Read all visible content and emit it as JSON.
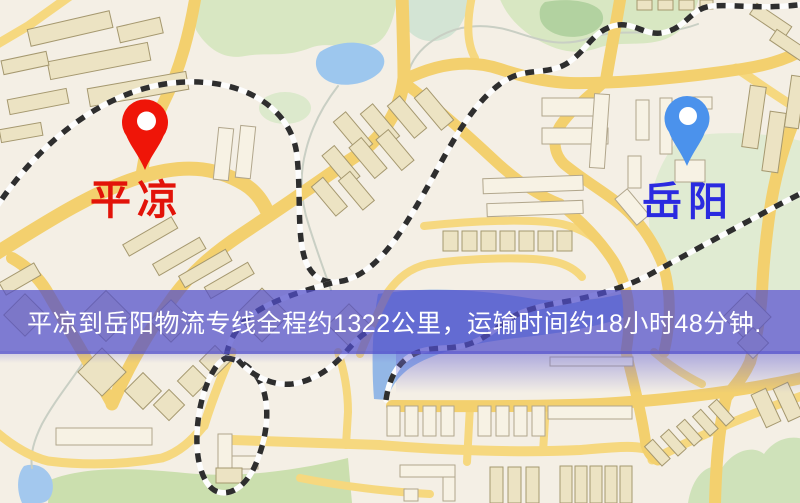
{
  "markers": {
    "origin": {
      "name": "平凉",
      "pin_color": "#ef1508",
      "label_color": "#e21309"
    },
    "destination": {
      "name": "岳阳",
      "pin_color": "#4b92ec",
      "label_color": "#2a2ae0"
    }
  },
  "banner": {
    "text": "平凉到岳阳物流专线全程约1322公里，运输时间约18小时48分钟.",
    "bg_color": "#504ecb",
    "text_color": "#ffffff",
    "route": {
      "origin": "平凉",
      "destination": "岳阳",
      "distance_km": "1322",
      "duration_hours": "18",
      "duration_minutes": "48"
    }
  },
  "map": {
    "palette": {
      "background": "#f4efe5",
      "road_major": "#f3d06e",
      "road_minor": "#f6d87f",
      "building_fill": "#ece3c3",
      "building_stroke": "#a5986f",
      "railway_dark": "#2e2e2e",
      "railway_light": "#fdfdfd",
      "water": "#9dc7ee",
      "green_area": "#d8e7c2",
      "overlay": "#504ecb"
    }
  }
}
